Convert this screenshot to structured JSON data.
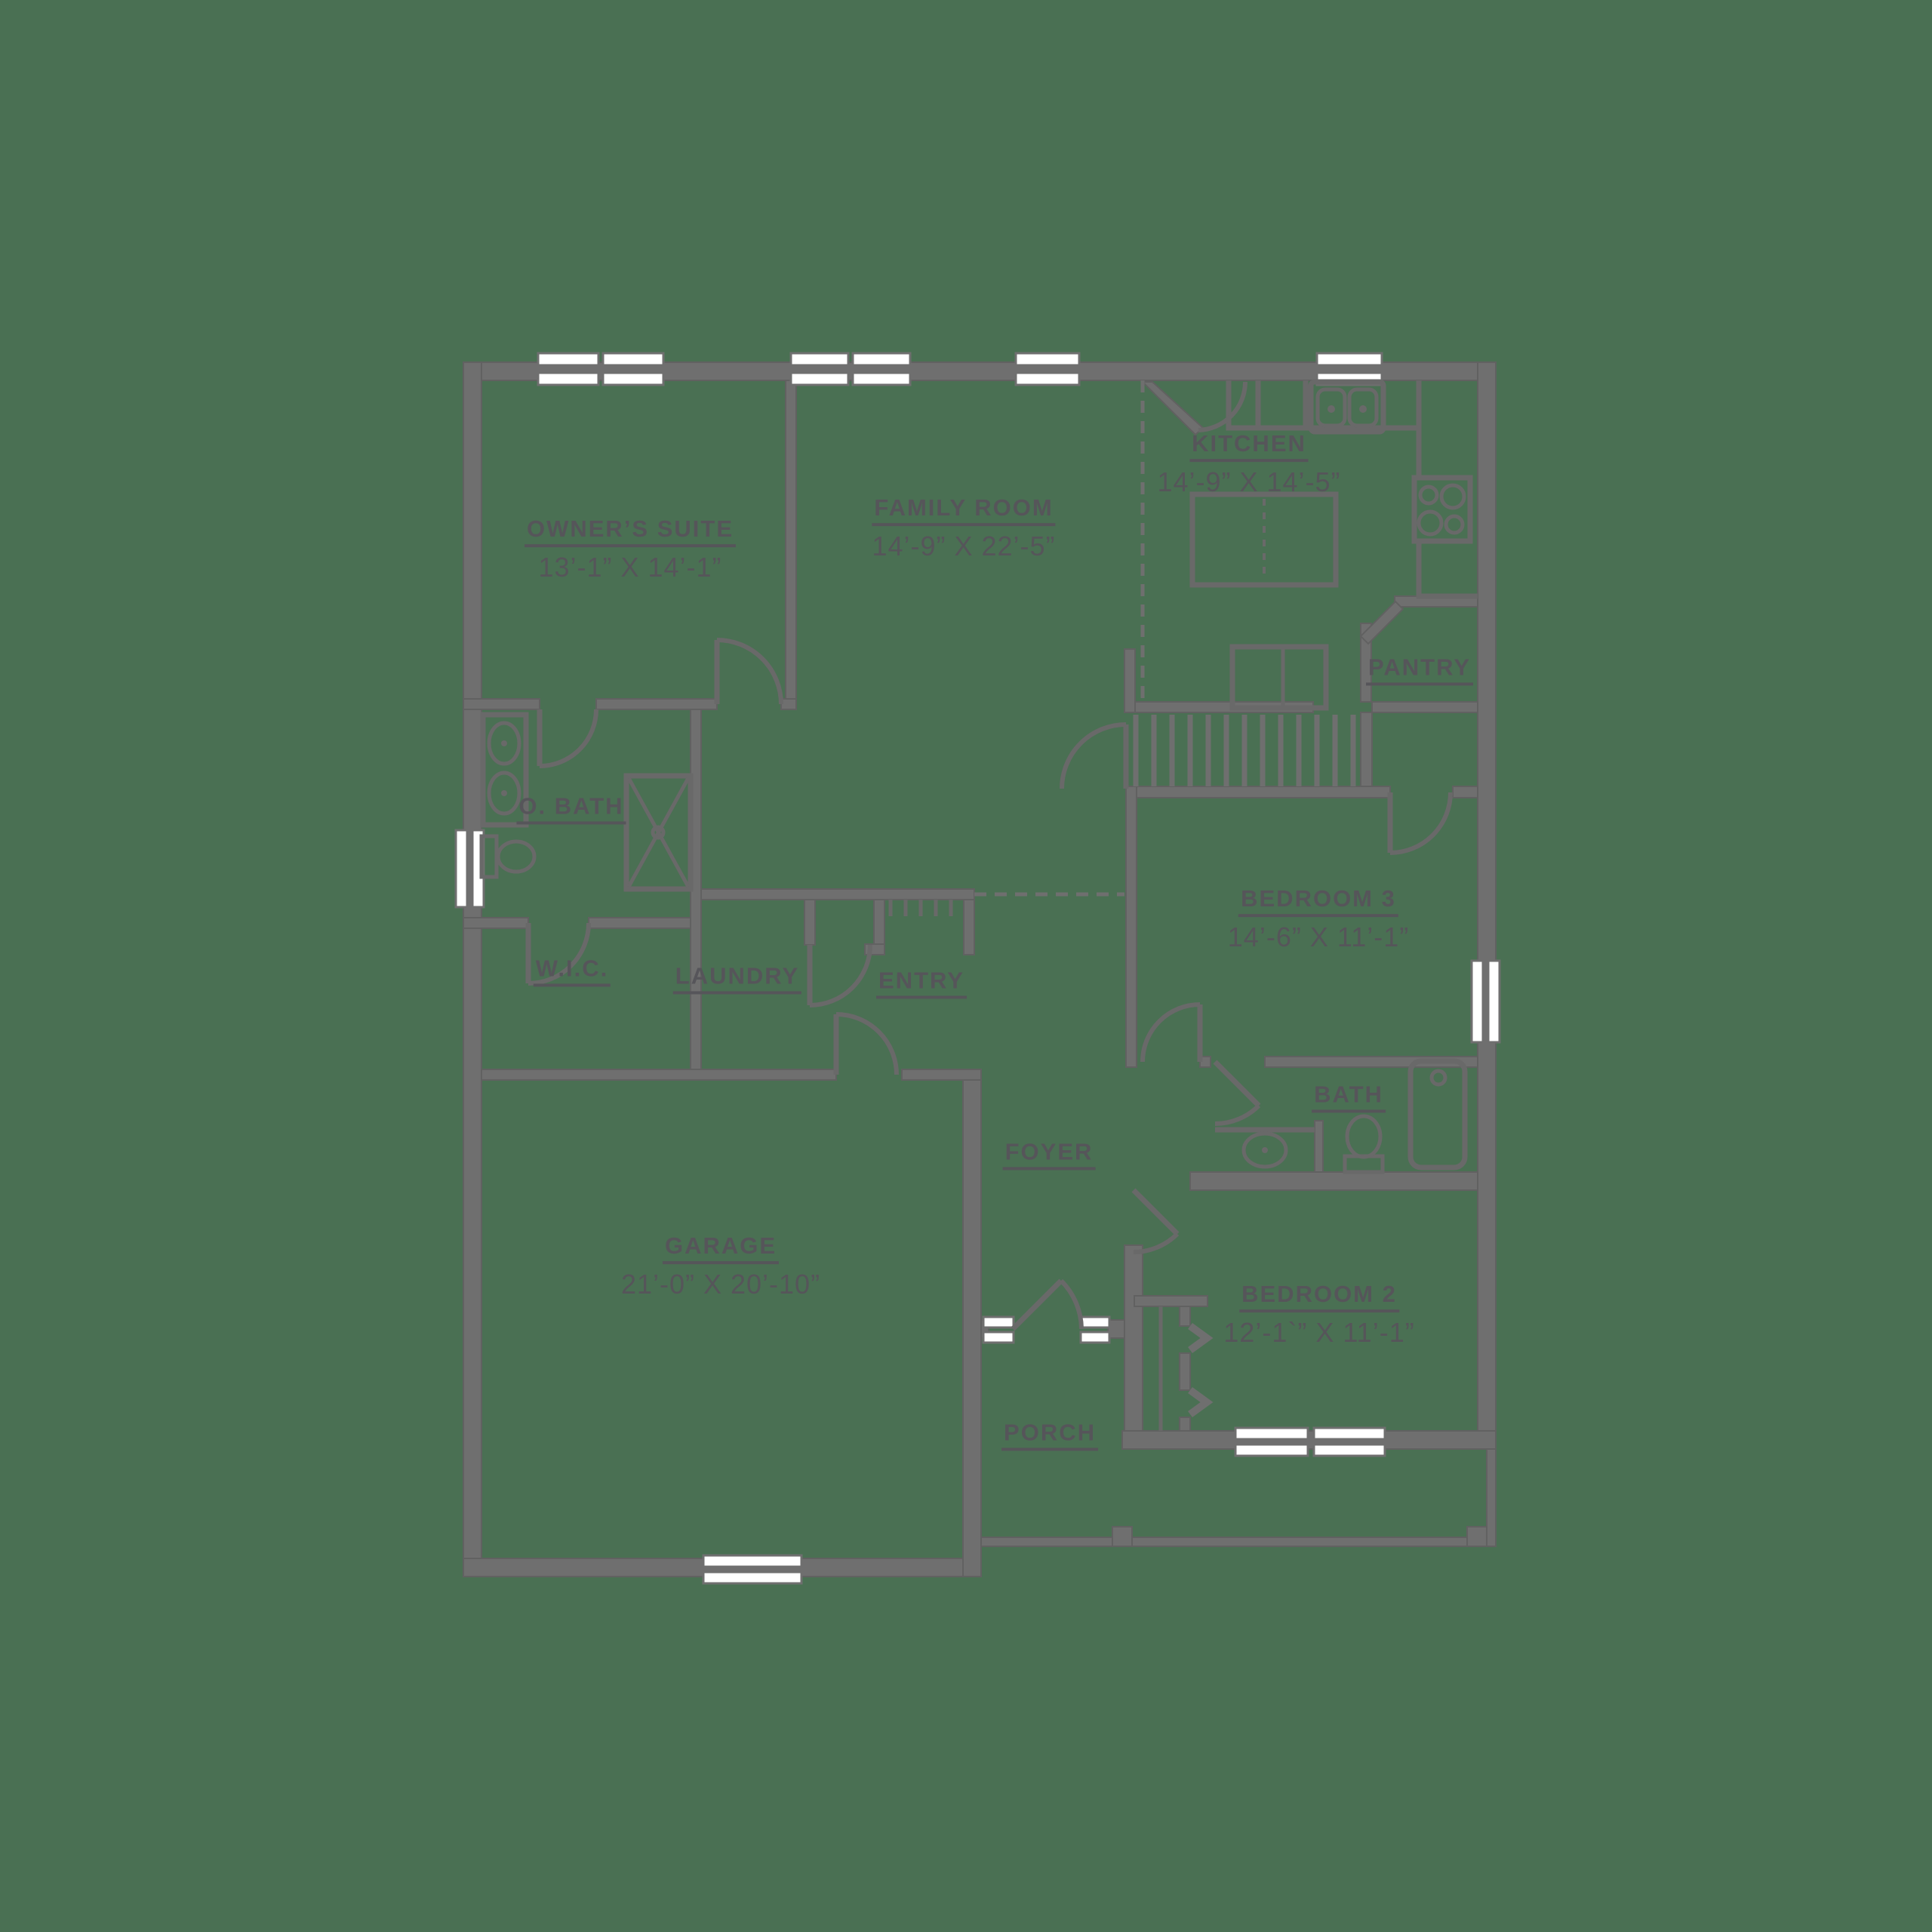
{
  "colors": {
    "background": "#4A7053",
    "wall": "#6F6F6F",
    "wall_edge": "#616161",
    "fixture": "#696969",
    "label": "#56555A",
    "window_fill": "#FFFFFF"
  },
  "rooms": {
    "owners_suite": {
      "name": "OWNER’S SUITE",
      "dims": "13’-1” X 14’-1”"
    },
    "family_room": {
      "name": "FAMILY ROOM",
      "dims": "14’-9” X 22’-5”"
    },
    "kitchen": {
      "name": "KITCHEN",
      "dims": "14’-9” X 14’-5”"
    },
    "pantry": {
      "name": "PANTRY",
      "dims": ""
    },
    "o_bath": {
      "name": "O. BATH",
      "dims": ""
    },
    "wic": {
      "name": "W.I.C.",
      "dims": ""
    },
    "laundry": {
      "name": "LAUNDRY",
      "dims": ""
    },
    "entry": {
      "name": "ENTRY",
      "dims": ""
    },
    "bedroom3": {
      "name": "BEDROOM 3",
      "dims": "14’-6” X 11’-1”"
    },
    "bath": {
      "name": "BATH",
      "dims": ""
    },
    "foyer": {
      "name": "FOYER",
      "dims": ""
    },
    "garage": {
      "name": "GARAGE",
      "dims": "21’-0” X 20’-10”"
    },
    "porch": {
      "name": "PORCH",
      "dims": ""
    },
    "bedroom2": {
      "name": "BEDROOM 2",
      "dims": "12’-1`” X 11’-1”"
    }
  }
}
